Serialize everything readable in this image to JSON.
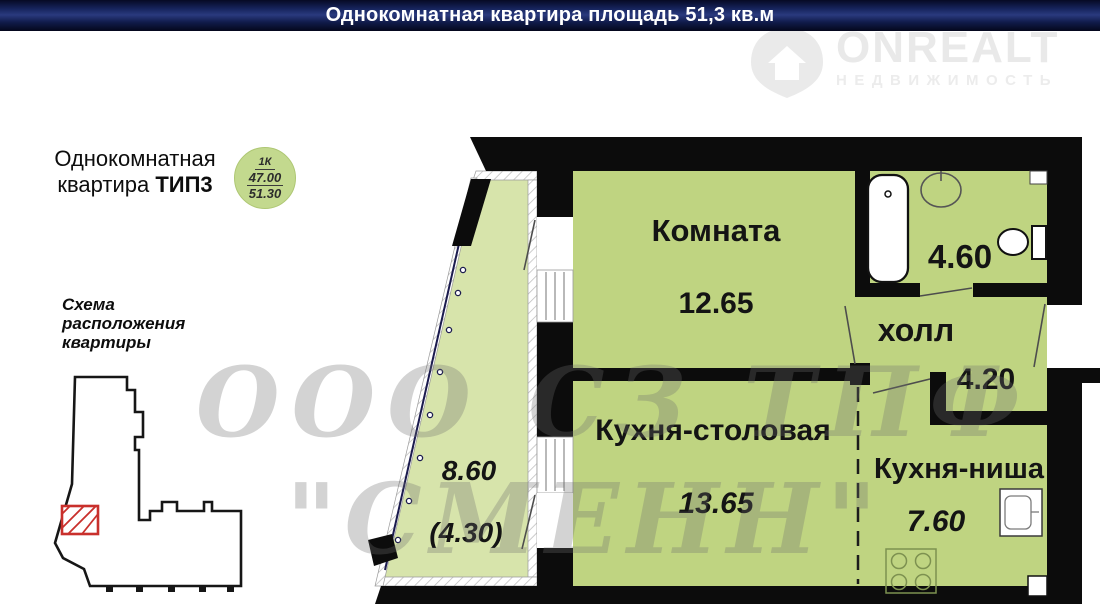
{
  "header": {
    "title": "Однокомнатная квартира площадь 51,3 кв.м"
  },
  "brand": {
    "name": "ONREALT",
    "tagline": "НЕДВИЖИМОСТЬ"
  },
  "apartment": {
    "title_line1": "Однокомнатная",
    "title_line2": "квартира",
    "type_label": "ТИП3",
    "badge": {
      "rooms": "1К",
      "living_area": "47.00",
      "total_area": "51.30"
    }
  },
  "scheme": {
    "title_line1": "Схема",
    "title_line2": "расположения",
    "title_line3": "квартиры"
  },
  "rooms": {
    "komnata": {
      "label": "Комната",
      "area": "12.65"
    },
    "kitchen_dining": {
      "label": "Кухня-столовая",
      "area": "13.65"
    },
    "kitchen_niche": {
      "label": "Кухня-ниша",
      "area": "7.60"
    },
    "hall": {
      "label": "холл",
      "area": "4.20"
    },
    "bathroom": {
      "area": "4.60"
    },
    "balcony": {
      "area": "8.60",
      "area_coefficient": "(4.30)"
    }
  },
  "watermark": {
    "line1": "ООО СЗ ТПФ",
    "line2": "\"СМЕНН\""
  },
  "colors": {
    "header_bg": "#1e2f6e",
    "room_fill": "#bfd481",
    "balcony_fill": "#d7e4ab",
    "wall": "#0c0c0c",
    "marker_red": "#c9302c",
    "badge_green": "#c3d98e"
  }
}
